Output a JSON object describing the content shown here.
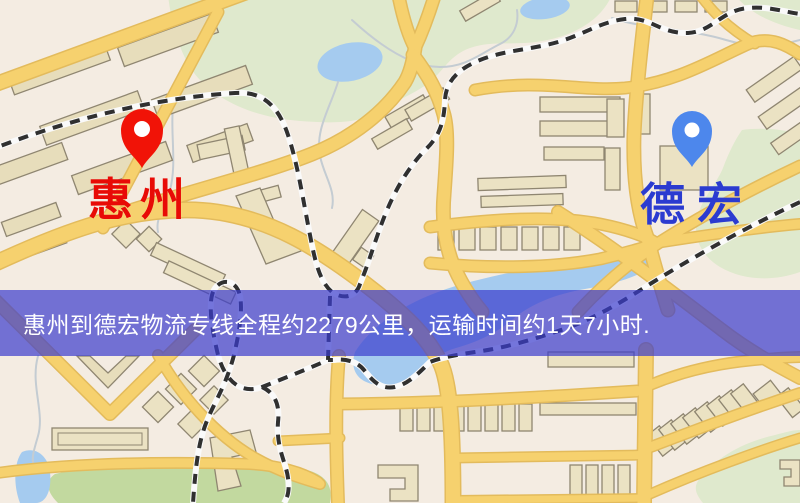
{
  "markers": {
    "origin": {
      "label": "惠州",
      "label_color": "#e80b06",
      "pin_color": "#ee1408",
      "icon": "map-pin-icon"
    },
    "destination": {
      "label": "德宏",
      "label_color": "#2b3bd0",
      "pin_color": "#4e87ea",
      "icon": "map-pin-icon"
    }
  },
  "banner": {
    "text": "惠州到德宏物流专线全程约2279公里，运输时间约1天7小时.",
    "background": "rgba(58,60,205,0.70)",
    "text_color": "#ffffff"
  },
  "map_colors": {
    "background": "#f4ece2",
    "park": "#dfe9cd",
    "park_dark": "#c2d9a0",
    "water": "#a6cbee",
    "road": "#f5d170",
    "road_casing": "#e2bb5e",
    "building": "#ebe2c4",
    "building_stroke": "#8f8671",
    "railway": "#303030",
    "railway_base": "#fafafa"
  }
}
